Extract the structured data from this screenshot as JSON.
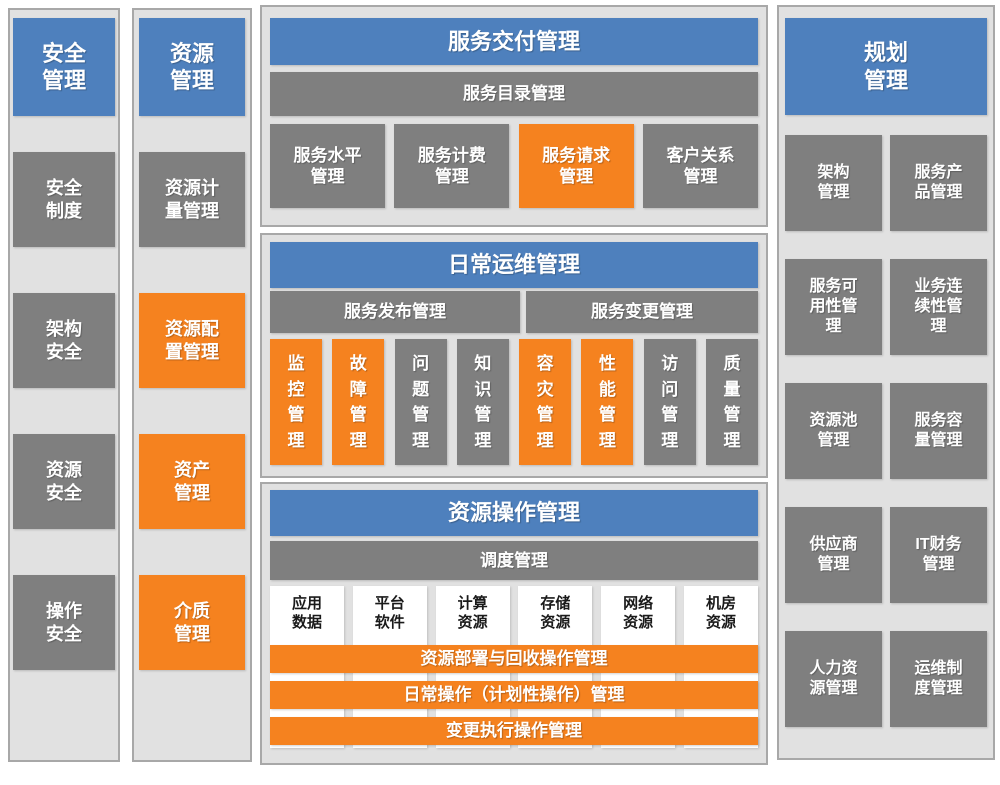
{
  "colors": {
    "blue": "#4e80bd",
    "gray": "#7f7f7f",
    "orange": "#f5821f",
    "panel_bg": "#e1e1e1",
    "panel_border": "#a8a8a8"
  },
  "security": {
    "title": "安全\n管理",
    "items": [
      "安全\n制度",
      "架构\n安全",
      "资源\n安全",
      "操作\n安全"
    ]
  },
  "resource": {
    "title": "资源\n管理",
    "items": [
      {
        "label": "资源计\n量管理",
        "color": "gray"
      },
      {
        "label": "资源配\n置管理",
        "color": "orange"
      },
      {
        "label": "资产\n管理",
        "color": "orange"
      },
      {
        "label": "介质\n管理",
        "color": "orange"
      }
    ]
  },
  "delivery": {
    "title": "服务交付管理",
    "bar": "服务目录管理",
    "items": [
      {
        "label": "服务水平\n管理",
        "color": "gray"
      },
      {
        "label": "服务计费\n管理",
        "color": "gray"
      },
      {
        "label": "服务请求\n管理",
        "color": "orange"
      },
      {
        "label": "客户关系\n管理",
        "color": "gray"
      }
    ]
  },
  "operations": {
    "title": "日常运维管理",
    "bars": [
      "服务发布管理",
      "服务变更管理"
    ],
    "items": [
      {
        "label": "监\n控\n管\n理",
        "color": "orange"
      },
      {
        "label": "故\n障\n管\n理",
        "color": "orange"
      },
      {
        "label": "问\n题\n管\n理",
        "color": "gray"
      },
      {
        "label": "知\n识\n管\n理",
        "color": "gray"
      },
      {
        "label": "容\n灾\n管\n理",
        "color": "orange"
      },
      {
        "label": "性\n能\n管\n理",
        "color": "orange"
      },
      {
        "label": "访\n问\n管\n理",
        "color": "gray"
      },
      {
        "label": "质\n量\n管\n理",
        "color": "gray"
      }
    ]
  },
  "resource_ops": {
    "title": "资源操作管理",
    "bar": "调度管理",
    "columns": [
      "应用\n数据",
      "平台\n软件",
      "计算\n资源",
      "存储\n资源",
      "网络\n资源",
      "机房\n资源"
    ],
    "bars": [
      "资源部署与回收操作管理",
      "日常操作（计划性操作）管理",
      "变更执行操作管理"
    ]
  },
  "planning": {
    "title": "规划\n管理",
    "items": [
      "架构\n管理",
      "服务产\n品管理",
      "服务可\n用性管\n理",
      "业务连\n续性管\n理",
      "资源池\n管理",
      "服务容\n量管理",
      "供应商\n管理",
      "IT财务\n管理",
      "人力资\n源管理",
      "运维制\n度管理"
    ]
  }
}
